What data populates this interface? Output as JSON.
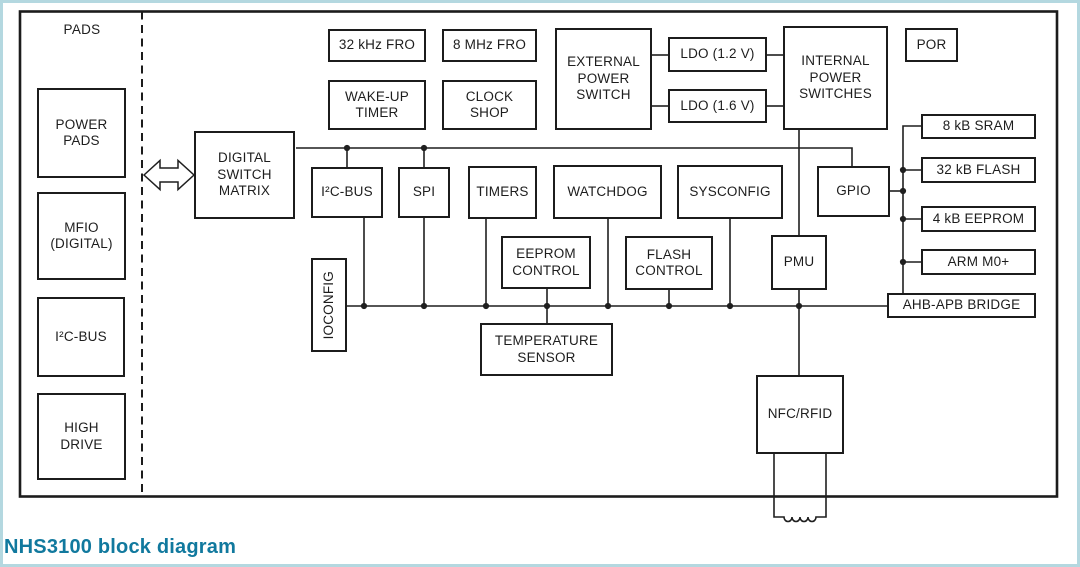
{
  "figure": {
    "caption": "NHS3100 block diagram",
    "pads_region_label": "PADS",
    "accent_caption_color": "#11799e",
    "frame_color": "#b4d8e0",
    "line_color": "#1f1f1f"
  },
  "blocks": {
    "power_pads": {
      "label": "POWER\nPADS"
    },
    "mfio": {
      "label": "MFIO\n(DIGITAL)"
    },
    "i2c_bus_pad": {
      "label": "I²C-BUS"
    },
    "high_drive": {
      "label": "HIGH\nDRIVE"
    },
    "digital_switch_matrix": {
      "label": "DIGITAL\nSWITCH\nMATRIX"
    },
    "fro_32k": {
      "label": "32 kHz FRO"
    },
    "fro_8m": {
      "label": "8 MHz FRO"
    },
    "wakeup_timer": {
      "label": "WAKE-UP\nTIMER"
    },
    "clock_shop": {
      "label": "CLOCK\nSHOP"
    },
    "external_power_switch": {
      "label": "EXTERNAL\nPOWER\nSWITCH"
    },
    "ldo_1v2": {
      "label": "LDO (1.2 V)"
    },
    "ldo_1v6": {
      "label": "LDO (1.6 V)"
    },
    "internal_power_switches": {
      "label": "INTERNAL\nPOWER\nSWITCHES"
    },
    "por": {
      "label": "POR"
    },
    "i2c_bus": {
      "label": "I²C-BUS"
    },
    "spi": {
      "label": "SPI"
    },
    "timers": {
      "label": "TIMERS"
    },
    "watchdog": {
      "label": "WATCHDOG"
    },
    "sysconfig": {
      "label": "SYSCONFIG"
    },
    "gpio": {
      "label": "GPIO"
    },
    "ioconfig": {
      "label": "IOCONFIG"
    },
    "eeprom_control": {
      "label": "EEPROM\nCONTROL"
    },
    "flash_control": {
      "label": "FLASH\nCONTROL"
    },
    "pmu": {
      "label": "PMU"
    },
    "sram_8k": {
      "label": "8 kB SRAM"
    },
    "flash_32k": {
      "label": "32 kB FLASH"
    },
    "eeprom_4k": {
      "label": "4 kB EEPROM"
    },
    "arm_m0": {
      "label": "ARM M0+"
    },
    "ahb_apb_bridge": {
      "label": "AHB-APB BRIDGE"
    },
    "temperature_sensor": {
      "label": "TEMPERATURE\nSENSOR"
    },
    "nfc_rfid": {
      "label": "NFC/RFID"
    }
  }
}
